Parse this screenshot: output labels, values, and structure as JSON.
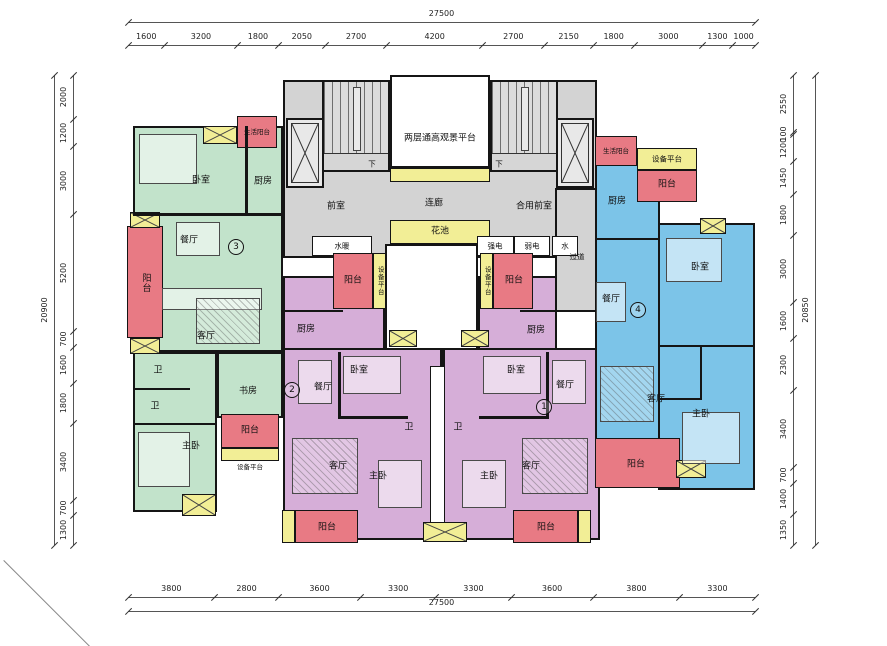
{
  "drawing": {
    "units": {
      "u1": {
        "no": "1"
      },
      "u2": {
        "no": "2"
      },
      "u3": {
        "no": "3"
      },
      "u4": {
        "no": "4"
      }
    },
    "rooms": {
      "bedroom": "卧室",
      "kitchen": "厨房",
      "dining": "餐厅",
      "living": "客厅",
      "bath": "卫",
      "study": "书房",
      "master_bedroom": "主卧",
      "balcony": "阳台",
      "life_balcony": "生活阳台",
      "equipment_platform": "设备平台"
    },
    "common": {
      "view_platform": "两层通高观景平台",
      "front_room": "前室",
      "corridor": "连廊",
      "shared_front_room": "合用前室",
      "flower_bed": "花池",
      "passage": "过道",
      "water_heating": "水暖",
      "strong_electric": "强电",
      "weak_electric": "弱电",
      "water": "水",
      "down": "下"
    },
    "dims": {
      "top": {
        "total": "27500",
        "segments": [
          "1600",
          "3200",
          "1800",
          "2050",
          "2700",
          "4200",
          "2700",
          "2150",
          "1800",
          "3000",
          "1300",
          "1000"
        ]
      },
      "bottom": {
        "total": "27500",
        "segments": [
          "3800",
          "2800",
          "3600",
          "3300",
          "3300",
          "3600",
          "3800",
          "3300"
        ]
      },
      "left": {
        "total": "20900",
        "segments": [
          "2000",
          "1200",
          "3000",
          "5200",
          "700",
          "1600",
          "1800",
          "3400",
          "700",
          "1300"
        ]
      },
      "right": {
        "total": "20850",
        "segments": [
          "2550",
          "100",
          "1200",
          "1450",
          "1800",
          "3000",
          "1600",
          "2300",
          "3400",
          "700",
          "1400",
          "1350"
        ]
      }
    },
    "colors": {
      "unit_green": "#c2e3cb",
      "unit_purple": "#d6aed8",
      "unit_blue": "#7cc4e8",
      "balcony_red": "#e87a84",
      "platform_yellow": "#f2ee96",
      "common_gray": "#d3d3d3",
      "wall": "#151515"
    }
  }
}
